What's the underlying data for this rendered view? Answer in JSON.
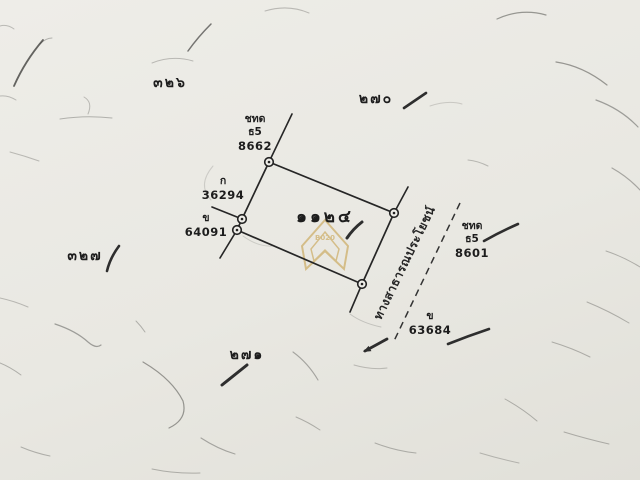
{
  "map": {
    "plot_number": "๑๑๒๔",
    "road_label": "ทางสาธารณประโยชน์",
    "grid_numbers": {
      "top_left": "๓๒๖",
      "top_right": "๒๗๐",
      "left": "๓๒๗",
      "bottom": "๒๗๑"
    },
    "boundary_markers": {
      "top": {
        "line1": "ชทด",
        "line2": "ธ5",
        "line3": "8662"
      },
      "left_upper": {
        "line1": "ก",
        "line2": "36294"
      },
      "left_lower": {
        "line1": "ข",
        "line2": "64091"
      },
      "right": {
        "line1": "ชทด",
        "line2": "ธ5",
        "line3": "8601"
      },
      "bottom_right": {
        "line1": "ข",
        "line2": "63684"
      }
    },
    "watermark_text": "B020",
    "colors": {
      "paper": "#eceae5",
      "ink": "#222222",
      "watermark_gold": "#c49a3f"
    }
  }
}
